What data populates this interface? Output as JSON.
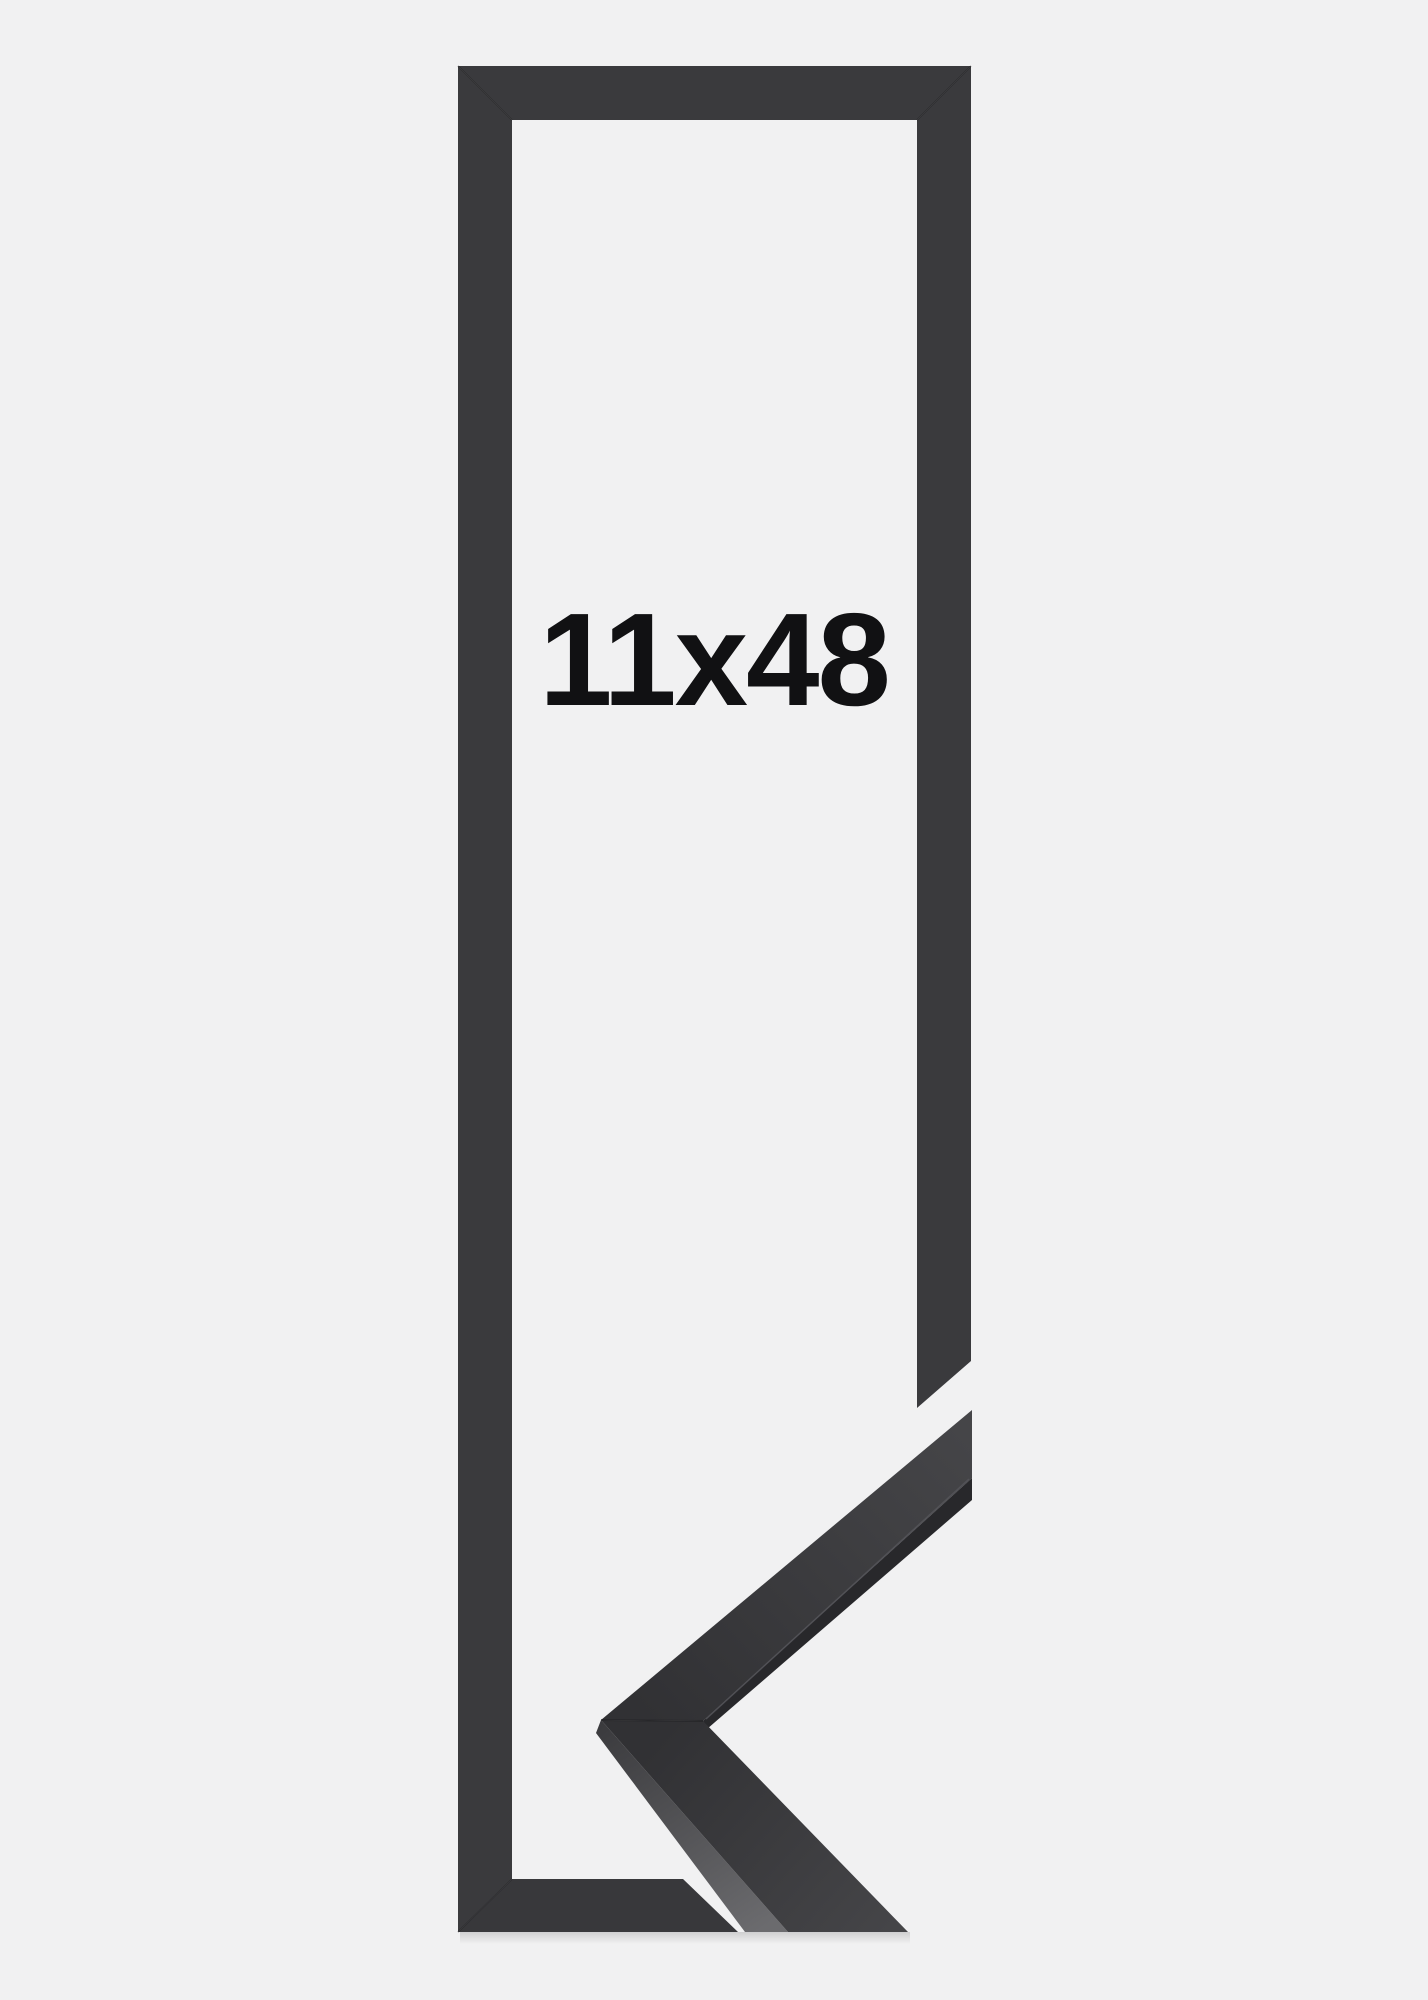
{
  "product_image": {
    "size_label": "11x48",
    "colors": {
      "background": "#f1f1f2",
      "frame_bar": "#3a3a3d",
      "frame_bar_bottom": "#38383b",
      "corner_face_near": "#454548",
      "corner_face_far": "#313134",
      "corner_side_dark": "#28282b",
      "corner_side_lit_near": "#3a3a3d",
      "corner_side_lit_far": "#6b6b6e",
      "seam_line": "#1f1f22",
      "arris_highlight": "#55555a",
      "label_text": "#111113"
    }
  }
}
